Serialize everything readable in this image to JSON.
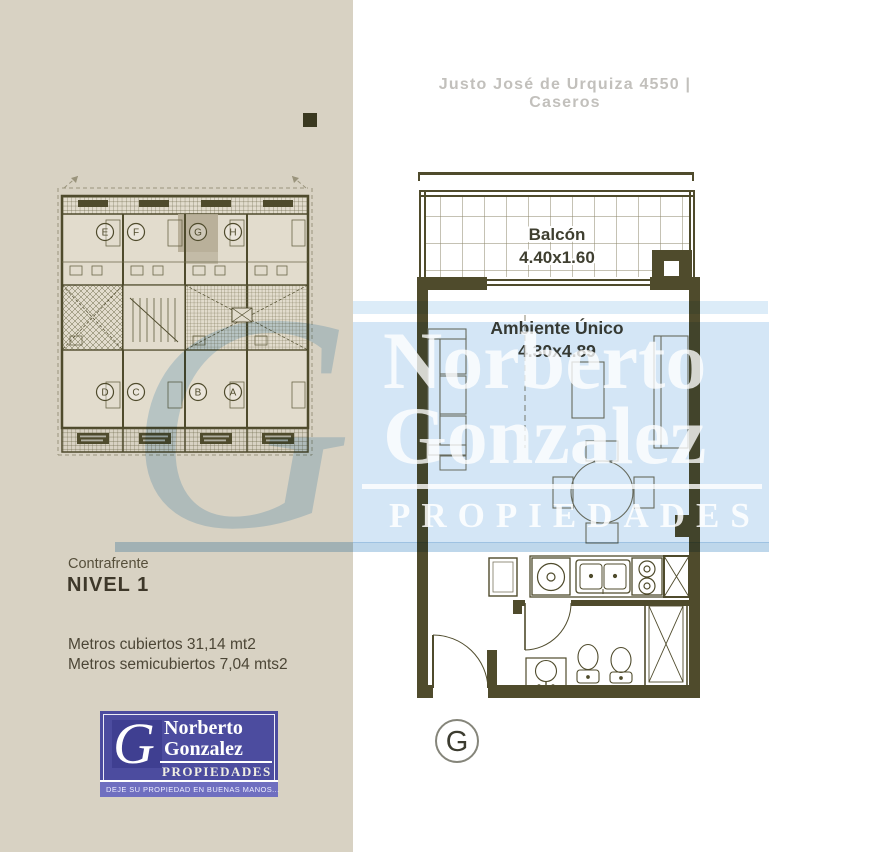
{
  "header": {
    "address": "Justo José de Urquiza 4550 | Caseros"
  },
  "sidebar": {
    "mini_plan": {
      "units_top": [
        "E",
        "F",
        "G",
        "H"
      ],
      "units_bottom": [
        "D",
        "C",
        "B",
        "A"
      ],
      "highlighted_unit": "G"
    },
    "front_label": "Contrafrente",
    "level_label": "NIVEL 1",
    "covered_area": "Metros cubiertos 31,14 mt2",
    "semicovered_area": "Metros semicubiertos 7,04 mts2"
  },
  "unit_plan": {
    "balcony_label": "Balcón",
    "balcony_dimensions": "4.40x1.60",
    "room_label": "Ambiente Único",
    "room_dimensions": "4.30x4.89",
    "unit_letter": "G"
  },
  "watermark": {
    "monogram": "G",
    "line1": "Norberto",
    "line2": "Gonzalez",
    "line3": "PROPIEDADES"
  },
  "logo": {
    "monogram": "G",
    "name_line1": "Norberto",
    "name_line2": "Gonzalez",
    "subtitle": "PROPIEDADES",
    "tagline": "DEJE SU PROPIEDAD EN BUENAS MANOS..."
  },
  "colors": {
    "wall": "#4f4b2c",
    "sidebar_background": "#d8d2c3",
    "plan_fill": "#e2dccd",
    "watermark_blue": "#d4e6f6",
    "logo_blue": "#4c4c9f",
    "logo_dark_blue": "#3f3f91",
    "logo_strip_blue": "#6f6fc0",
    "header_text": "#c2c0bc"
  }
}
